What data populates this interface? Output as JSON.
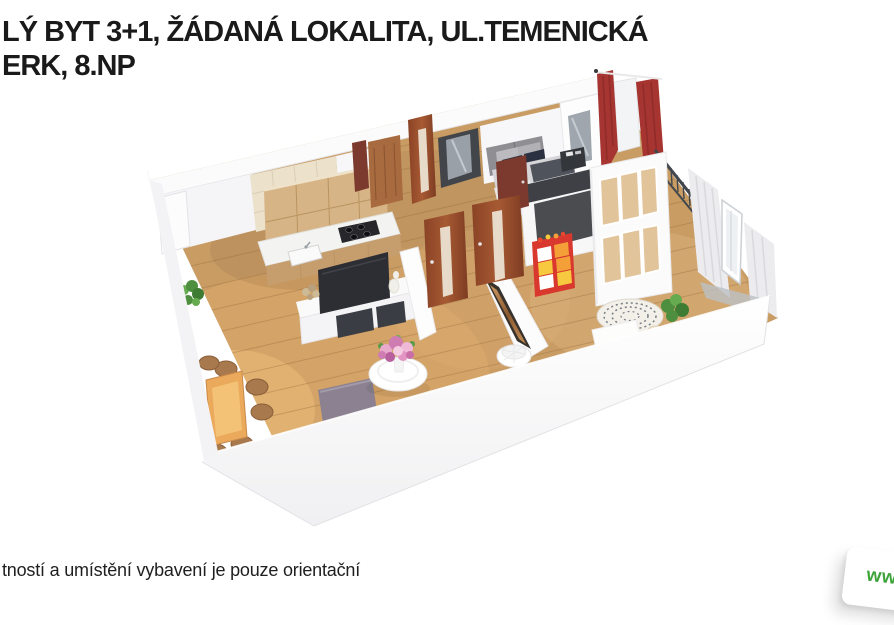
{
  "header": {
    "line1": "LÝ BYT 3+1, ŽÁDANÁ LOKALITA, UL.TEMENICKÁ",
    "line2": "ERK, 8.NP"
  },
  "footer": {
    "disclaimer": "tností a umístění vybavení je pouze orientační"
  },
  "watermark": {
    "text": "www"
  },
  "floorplan": {
    "type": "3d-floor-plan-render",
    "rooms": [
      "kitchen",
      "living-room-with-dining",
      "bedroom",
      "childrens-room",
      "hallway",
      "balcony"
    ],
    "colors": {
      "text_dark": "#1a1a1a",
      "watermark_green": "#3da33a",
      "wood_floor": "#c99c64",
      "walls_white": "#f8f8f9",
      "doors_wood": "#9a4f2e",
      "doors_dark_red": "#7c3a2f",
      "curtains_red": "#a63430",
      "curtains_white": "#ececef",
      "kitchen_cabinets": "#d7b485",
      "bed_blanket": "#4e535c",
      "toy_storage_red": "#d8382e",
      "toy_bins_orange": "#f59f38",
      "toy_bins_yellow": "#f7c93e",
      "plants": "#4d8f3e",
      "rug_gray": "#8b8190",
      "dining_table": "#eaa95b"
    }
  }
}
